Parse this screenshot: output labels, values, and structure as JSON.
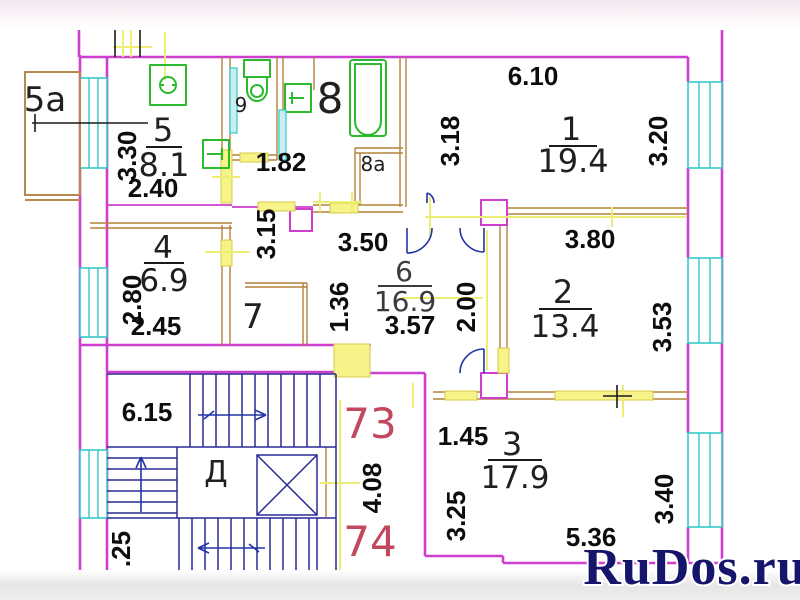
{
  "title": "apartment-floor-plan",
  "colors": {
    "exterior_wall": "#cf3fcf",
    "partition_wall": "#b5813c",
    "window": "#35c8c8",
    "dimension_line": "#eded74",
    "fixture": "#2db92d",
    "stairs": "#2a2a96",
    "apartment_number": "#c2485e",
    "watermark": "#15156b"
  },
  "rooms": [
    {
      "number": "1",
      "area": "19.4"
    },
    {
      "number": "2",
      "area": "13.4"
    },
    {
      "number": "3",
      "area": "17.9"
    },
    {
      "number": "4",
      "area": "6.9"
    },
    {
      "number": "5",
      "area": "8.1"
    },
    {
      "number": "6",
      "area": "16.9"
    }
  ],
  "units": {
    "balcony": "5a",
    "wc": "9",
    "bath": "8",
    "bath_closet": "8a",
    "pantry": "7"
  },
  "dimensions": {
    "d330": "3.30",
    "d240": "2.40",
    "d182": "1.82",
    "d315": "3.15",
    "d610": "6.10",
    "d318": "3.18",
    "d320": "3.20",
    "d350": "3.50",
    "d380": "3.80",
    "d280": "2.80",
    "d245": "2.45",
    "d136": "1.36",
    "d357": "3.57",
    "d200": "2.00",
    "d353": "3.53",
    "d145": "1.45",
    "d325": "3.25",
    "d536": "5.36",
    "d340": "3.40"
  },
  "stairwell": {
    "width_label": "6.15",
    "door_mark": "Д",
    "apartment_top": "73",
    "apartment_bottom": "74",
    "depth_label": "4.08",
    "edge_label": ".25"
  },
  "watermark": {
    "text": "RuDos.ru"
  }
}
